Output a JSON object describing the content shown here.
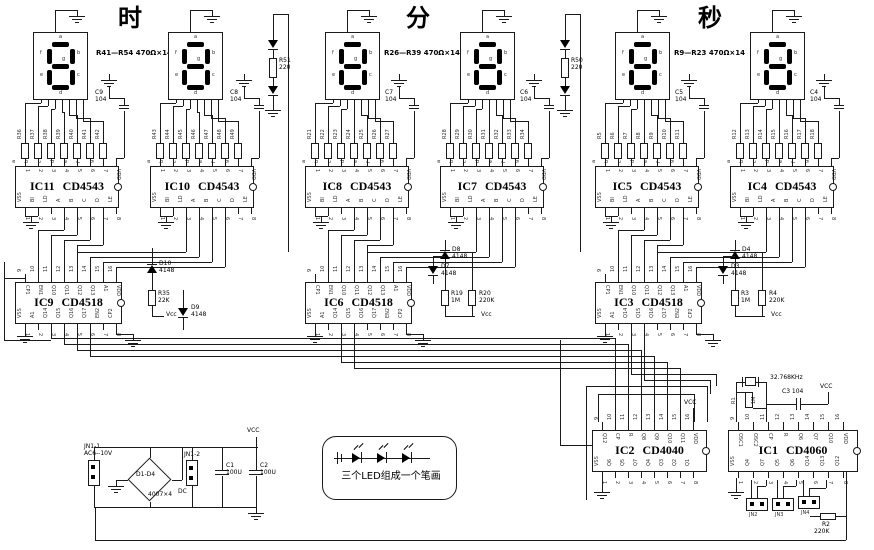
{
  "titles": {
    "hour": "时",
    "minute": "分",
    "second": "秒"
  },
  "annotations": {
    "hour": "R41—R54 470Ω×14",
    "minute": "R26—R39 470Ω×14",
    "second": "R9—R23 470Ω×14"
  },
  "segment_letters": [
    "a",
    "f",
    "b",
    "g",
    "e",
    "c",
    "d"
  ],
  "segment_pins": [
    "a",
    "b",
    "c",
    "d",
    "e",
    "f",
    "g"
  ],
  "pin_numbers": {
    "top": [
      "9",
      "10",
      "11",
      "12",
      "13",
      "14",
      "15",
      "16"
    ],
    "bottom": [
      "1",
      "2",
      "3",
      "4",
      "5",
      "6",
      "7",
      "8"
    ]
  },
  "ic_pin_labels": {
    "cd4543_top": [
      "1",
      "2",
      "3",
      "4",
      "5",
      "6",
      "7",
      "VDD"
    ],
    "cd4543_bottom": [
      "VSS",
      "BI",
      "LD",
      "A",
      "B",
      "C",
      "D",
      "LE"
    ],
    "cd4518_top": [
      "CP1",
      "EN1",
      "Q10",
      "Q11",
      "Q12",
      "Q13",
      "A1",
      "VDD"
    ],
    "cd4518_bottom": [
      "VSS",
      "A1",
      "Q14",
      "Q15",
      "Q16",
      "Q17",
      "EN2",
      "CP2"
    ],
    "cd4040_top": [
      "Q12",
      "CP",
      "R",
      "Q8",
      "Q9",
      "Q10",
      "Q11",
      "VDD"
    ],
    "cd4040_bottom": [
      "VSS",
      "Q6",
      "Q5",
      "Q7",
      "Q4",
      "Q3",
      "Q2",
      "Q1"
    ],
    "cd4060_top": [
      "OSC1",
      "OSC2",
      "CP",
      "R",
      "Q6",
      "Q7",
      "Q10",
      "VDD"
    ],
    "cd4060_bottom": [
      "VSS",
      "Q4",
      "Q7",
      "Q5",
      "Q6",
      "Q14",
      "Q13",
      "Q12"
    ]
  },
  "display_groups": [
    {
      "cap": "C9",
      "cap_val": "104",
      "resistors": [
        "R36",
        "R37",
        "R38",
        "R39",
        "R40",
        "R41",
        "R42"
      ]
    },
    {
      "cap": "C8",
      "cap_val": "104",
      "resistors": [
        "R43",
        "R44",
        "R45",
        "R46",
        "R47",
        "R48",
        "R49"
      ]
    },
    {
      "cap": "C7",
      "cap_val": "104",
      "resistors": [
        "R21",
        "R22",
        "R23",
        "R24",
        "R25",
        "R26",
        "R27"
      ]
    },
    {
      "cap": "C6",
      "cap_val": "104",
      "resistors": [
        "R28",
        "R29",
        "R30",
        "R31",
        "R32",
        "R33",
        "R34"
      ]
    },
    {
      "cap": "C5",
      "cap_val": "104",
      "resistors": [
        "R5",
        "R6",
        "R7",
        "R8",
        "R9",
        "R10",
        "R11"
      ]
    },
    {
      "cap": "C4",
      "cap_val": "104",
      "resistors": [
        "R12",
        "R13",
        "R14",
        "R15",
        "R16",
        "R17",
        "R18"
      ]
    }
  ],
  "decoders": [
    {
      "name": "IC11",
      "part": "CD4543"
    },
    {
      "name": "IC10",
      "part": "CD4543"
    },
    {
      "name": "IC8",
      "part": "CD4543"
    },
    {
      "name": "IC7",
      "part": "CD4543"
    },
    {
      "name": "IC5",
      "part": "CD4543"
    },
    {
      "name": "IC4",
      "part": "CD4543"
    }
  ],
  "counters": [
    {
      "name": "IC9",
      "part": "CD4518"
    },
    {
      "name": "IC6",
      "part": "CD4518"
    },
    {
      "name": "IC3",
      "part": "CD4518"
    }
  ],
  "colon_leds": [
    {
      "name": "R51",
      "value": "220"
    },
    {
      "name": "R50",
      "value": "220"
    }
  ],
  "aux": {
    "hour": {
      "d_top": {
        "name": "D10",
        "part": "4148"
      },
      "d_side": {
        "name": "D9",
        "part": "4148"
      },
      "r1": {
        "name": "R35",
        "value": "22K"
      },
      "vcc": "Vcc"
    },
    "minute": {
      "d_top": {
        "name": "D8",
        "part": "4148"
      },
      "d_side": {
        "name": "D7",
        "part": "4148"
      },
      "r1": {
        "name": "R19",
        "value": "1M"
      },
      "r2": {
        "name": "R20",
        "value": "220K"
      },
      "vcc": "Vcc"
    },
    "second": {
      "d_top": {
        "name": "D4",
        "part": "4148"
      },
      "d_side": {
        "name": "D3",
        "part": "4148"
      },
      "r1": {
        "name": "R3",
        "value": "1M"
      },
      "r2": {
        "name": "R4",
        "value": "220K"
      },
      "vcc": "Vcc"
    }
  },
  "power": {
    "conn1": "JN1-1",
    "ac": "AC6--10V",
    "bridge": "D1-D4",
    "bridge_part": "4007×4",
    "conn2": "JN1-2",
    "dc": "DC",
    "c1": "C1",
    "c1_val": "100U",
    "c2": "C2",
    "c2_val": "100U",
    "vcc": "VCC"
  },
  "note": "三个LED组成一个笔画",
  "clock": {
    "ic2": {
      "name": "IC2",
      "part": "CD4040"
    },
    "ic1": {
      "name": "IC1",
      "part": "CD4060"
    },
    "crystal": "32.768KHz",
    "r1": {
      "name": "R1",
      "value": "1M"
    },
    "c3": "C3  104",
    "vcc": "VCC",
    "connectors": [
      "JN2",
      "JN3",
      "JN4"
    ],
    "r2": {
      "name": "R2",
      "value": "220K"
    }
  }
}
